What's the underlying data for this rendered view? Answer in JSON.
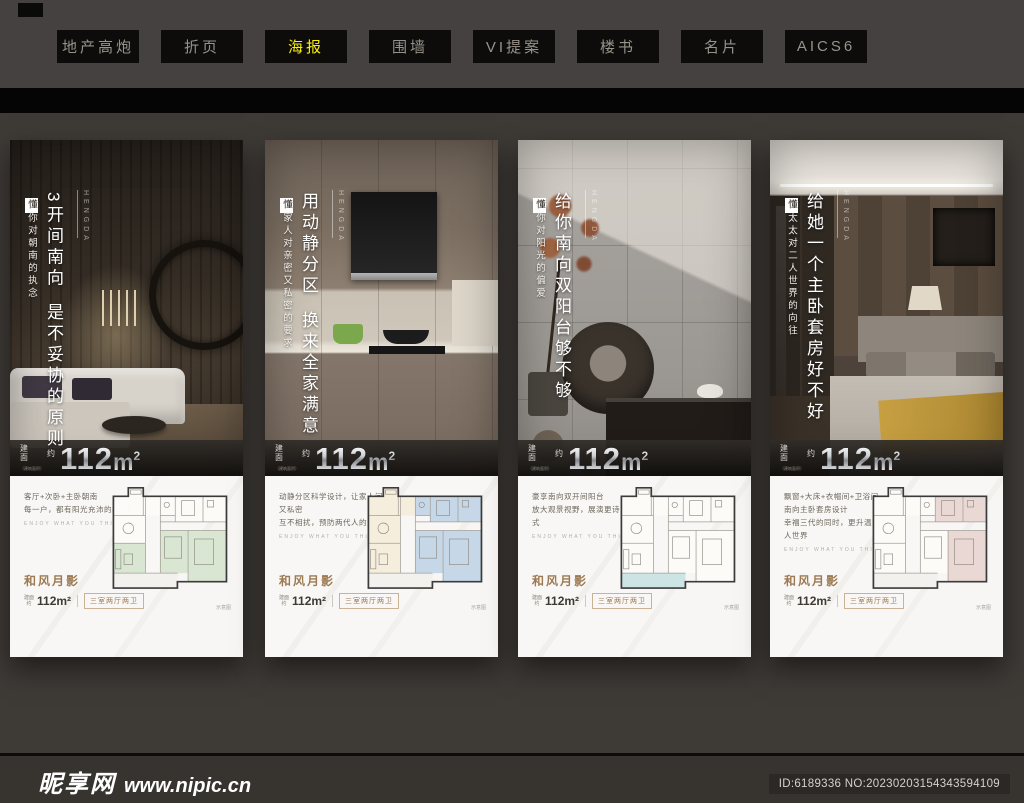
{
  "tabs": [
    {
      "label": "地产高炮",
      "active": false
    },
    {
      "label": "折页",
      "active": false
    },
    {
      "label": "海报",
      "active": true
    },
    {
      "label": "围墙",
      "active": false
    },
    {
      "label": "VI提案",
      "active": false
    },
    {
      "label": "楼书",
      "active": false
    },
    {
      "label": "名片",
      "active": false
    },
    {
      "label": "AICS6",
      "active": false
    }
  ],
  "posters": [
    {
      "brand": "HENGDA",
      "sub_lead": "懂",
      "sub_rest": "你对朝南的执念",
      "headline_1": "3开间南向",
      "headline_2": "是不妥协的原则",
      "band": {
        "label_top": "建",
        "label_bottom": "面",
        "approx": "约",
        "value": "112",
        "unit": "m",
        "sup": "2",
        "note": "（建筑面积）"
      },
      "desc_line_1": "客厅+次卧+主卧朝南",
      "desc_line_2": "每一户，都有阳光充沛的极致体验",
      "slogan": "ENJOY WHAT YOU THINK",
      "plan_name": "和风月影",
      "plan_label_1": "建面",
      "plan_label_2": "约",
      "plan_area": "112m²",
      "plan_type": "三室两厅两卫",
      "plan_note": "示意图",
      "plan_highlight": "#d9e6d2"
    },
    {
      "brand": "HENGDA",
      "sub_lead": "懂",
      "sub_rest": "家人对亲密又私密的要求",
      "headline_1": "用动静分区",
      "headline_2": "换来全家满意",
      "band": {
        "label_top": "建",
        "label_bottom": "面",
        "approx": "约",
        "value": "112",
        "unit": "m",
        "sup": "2",
        "note": "（建筑面积）"
      },
      "desc_line_1": "动静分区科学设计，让家人间亲密又私密",
      "desc_line_2": "互不相扰，预防两代人的生活冲突",
      "slogan": "ENJOY WHAT YOU THINK",
      "plan_name": "和风月影",
      "plan_label_1": "建面",
      "plan_label_2": "约",
      "plan_area": "112m²",
      "plan_type": "三室两厅两卫",
      "plan_note": "示意图",
      "plan_highlight": "#c6d8e8",
      "plan_public": "#f6eedd"
    },
    {
      "brand": "HENGDA",
      "sub_lead": "懂",
      "sub_rest": "你对阳光的偏爱",
      "headline_1": "给你南向双阳台够不够",
      "headline_2": "",
      "band": {
        "label_top": "建",
        "label_bottom": "面",
        "approx": "约",
        "value": "112",
        "unit": "m",
        "sup": "2",
        "note": "（建筑面积）"
      },
      "desc_line_1": "豪享南向双开间阳台",
      "desc_line_2": "放大观景视野，展演更诗意生活方式",
      "slogan": "ENJOY WHAT YOU THINK",
      "plan_name": "和风月影",
      "plan_label_1": "建面",
      "plan_label_2": "约",
      "plan_area": "112m²",
      "plan_type": "三室两厅两卫",
      "plan_note": "示意图",
      "plan_highlight": "#cde4e5"
    },
    {
      "brand": "HENGDA",
      "sub_lead": "懂",
      "sub_rest": "太太对二人世界的向往",
      "headline_1": "给她一个主卧套房好不好",
      "headline_2": "",
      "band": {
        "label_top": "建",
        "label_bottom": "面",
        "approx": "约",
        "value": "112",
        "unit": "m",
        "sup": "2",
        "note": "（建筑面积）"
      },
      "desc_line_1": "飘窗+大床+衣帽间+卫浴间",
      "desc_line_2": "南向主卧套房设计",
      "desc_line_3": "幸福三代的同时，更升温夫妻的二人世界",
      "slogan": "ENJOY WHAT YOU THINK",
      "plan_name": "和风月影",
      "plan_label_1": "建面",
      "plan_label_2": "约",
      "plan_area": "112m²",
      "plan_type": "三室两厅两卫",
      "plan_note": "示意图",
      "plan_highlight": "#ead8d4"
    }
  ],
  "footer": {
    "watermark_name": "昵享网",
    "watermark_url": "www.nipic.cn",
    "id_label": "ID:6189336 NO:20230203154343594109"
  }
}
